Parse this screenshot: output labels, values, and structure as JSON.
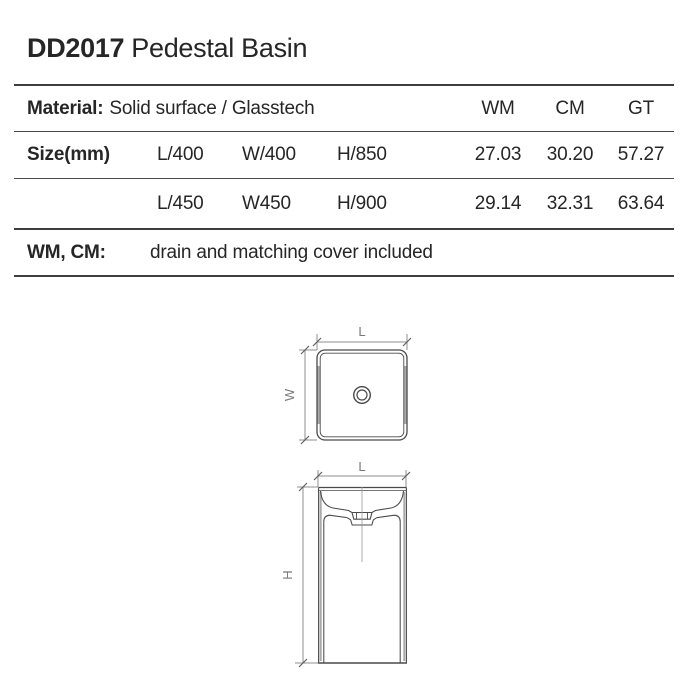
{
  "header": {
    "model": "DD2017",
    "product": "Pedestal Basin"
  },
  "table": {
    "material_label": "Material:",
    "material_value": "Solid surface / Glasstech",
    "price_columns": [
      "WM",
      "CM",
      "GT"
    ],
    "size_label": "Size(mm)",
    "rows": [
      {
        "l": "L/400",
        "w": "W/400",
        "h": "H/850",
        "wm": "27.03",
        "cm": "30.20",
        "gt": "57.27"
      },
      {
        "l": "L/450",
        "w": "W450",
        "h": "H/900",
        "wm": "29.14",
        "cm": "32.31",
        "gt": "63.64"
      }
    ],
    "note_label": "WM, CM:",
    "note_value": "drain and matching cover included"
  },
  "drawings": {
    "top_view": {
      "dim_horizontal": "L",
      "dim_vertical": "W"
    },
    "front_view": {
      "dim_horizontal": "L",
      "dim_vertical": "H"
    }
  },
  "colors": {
    "ink": "#262626",
    "rule": "#3d3d3d",
    "drawing_line": "#4a4a4a",
    "dimension_line": "#8f8f8f",
    "dimension_text": "#7a7a7a",
    "edge_shading": "#ababab",
    "background": "#ffffff"
  }
}
